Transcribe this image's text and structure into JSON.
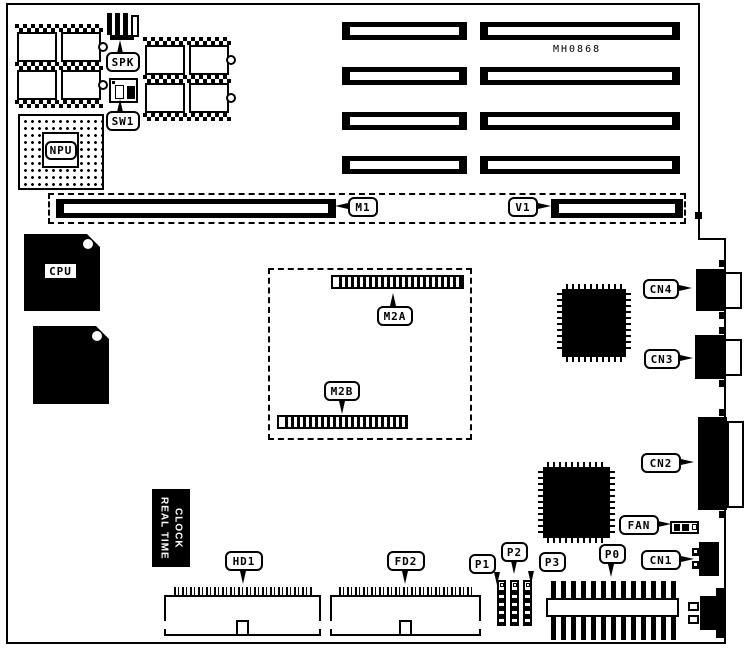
{
  "diagram": {
    "part_number": "MH0868",
    "cpu_label": "CPU",
    "npu_label": "NPU",
    "rtc": {
      "line1": "REAL TIME",
      "line2": "CLOCK"
    },
    "callouts": {
      "spk": "SPK",
      "sw1": "SW1",
      "m1": "M1",
      "v1": "V1",
      "m2a": "M2A",
      "m2b": "M2B",
      "cn4": "CN4",
      "cn3": "CN3",
      "cn2": "CN2",
      "cn1": "CN1",
      "fan": "FAN",
      "p0": "P0",
      "p1": "P1",
      "p2": "P2",
      "p3": "P3",
      "hd1": "HD1",
      "fd2": "FD2"
    },
    "colors": {
      "ink": "#000000",
      "paper": "#ffffff"
    }
  }
}
